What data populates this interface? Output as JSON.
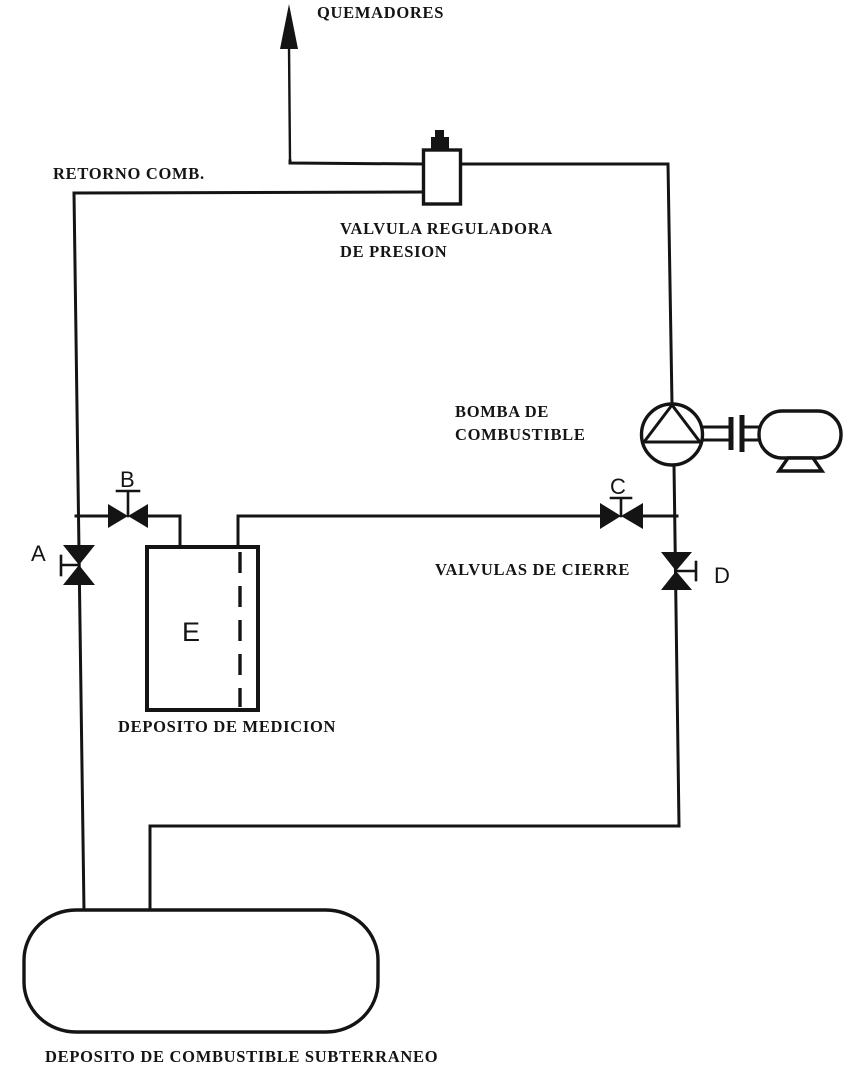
{
  "diagram": {
    "background": "#ffffff",
    "ink": "#141414",
    "labels": {
      "burners": "QUEMADORES",
      "fuel_return": "RETORNO COMB.",
      "pressure_regulator_line1": "VALVULA REGULADORA",
      "pressure_regulator_line2": "DE PRESION",
      "fuel_pump_line1": "BOMBA DE",
      "fuel_pump_line2": "COMBUSTIBLE",
      "shutoff_valves": "VALVULAS DE CIERRE",
      "measuring_tank": "DEPOSITO DE MEDICION",
      "underground_tank": "DEPOSITO DE COMBUSTIBLE SUBTERRANEO"
    },
    "valve_tags": {
      "a": "A",
      "b": "B",
      "c": "C",
      "d": "D"
    },
    "equipment_tags": {
      "measuring_tank": "E"
    },
    "components": [
      {
        "tag": "A",
        "type": "shutoff-valve",
        "orientation": "vertical-line"
      },
      {
        "tag": "B",
        "type": "shutoff-valve",
        "orientation": "horizontal-line"
      },
      {
        "tag": "C",
        "type": "shutoff-valve",
        "orientation": "horizontal-line"
      },
      {
        "tag": "D",
        "type": "shutoff-valve",
        "orientation": "vertical-line"
      },
      {
        "tag": "E",
        "type": "measuring-tank"
      },
      {
        "tag": "",
        "type": "pressure-regulating-valve"
      },
      {
        "tag": "",
        "type": "fuel-pump-with-motor"
      },
      {
        "tag": "",
        "type": "underground-fuel-tank"
      }
    ]
  }
}
